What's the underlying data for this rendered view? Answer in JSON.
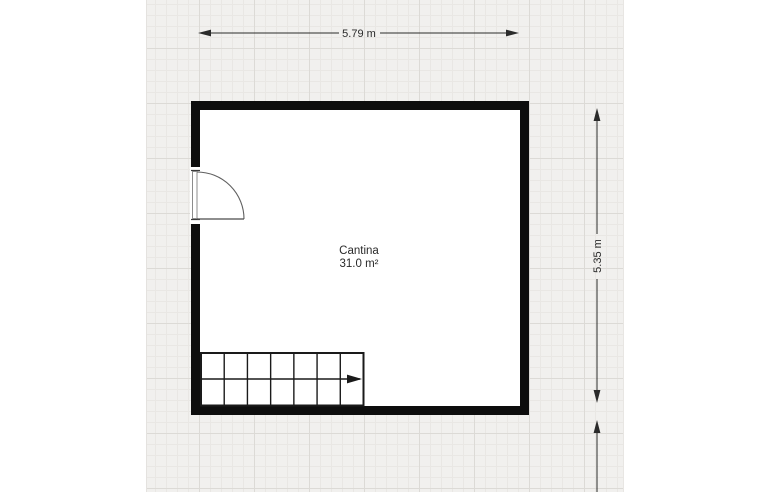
{
  "floorplan": {
    "room": {
      "name": "Cantina",
      "area_label": "31.0 m²"
    },
    "dimensions": {
      "top": "5.79 m",
      "right": "5.35 m"
    },
    "stairs": {
      "treads": 7,
      "direction": "right"
    },
    "colors": {
      "wall": "#0d0d0d",
      "canvas_background": "#f1f0ee",
      "grid_minor": "#e9e7e4",
      "grid_major": "#dcdad6",
      "dimension_line": "#2b2b2b",
      "door_line": "#5f5f5f",
      "stairs_line": "#1a1a1a",
      "label_text": "#2a2a2a"
    }
  }
}
